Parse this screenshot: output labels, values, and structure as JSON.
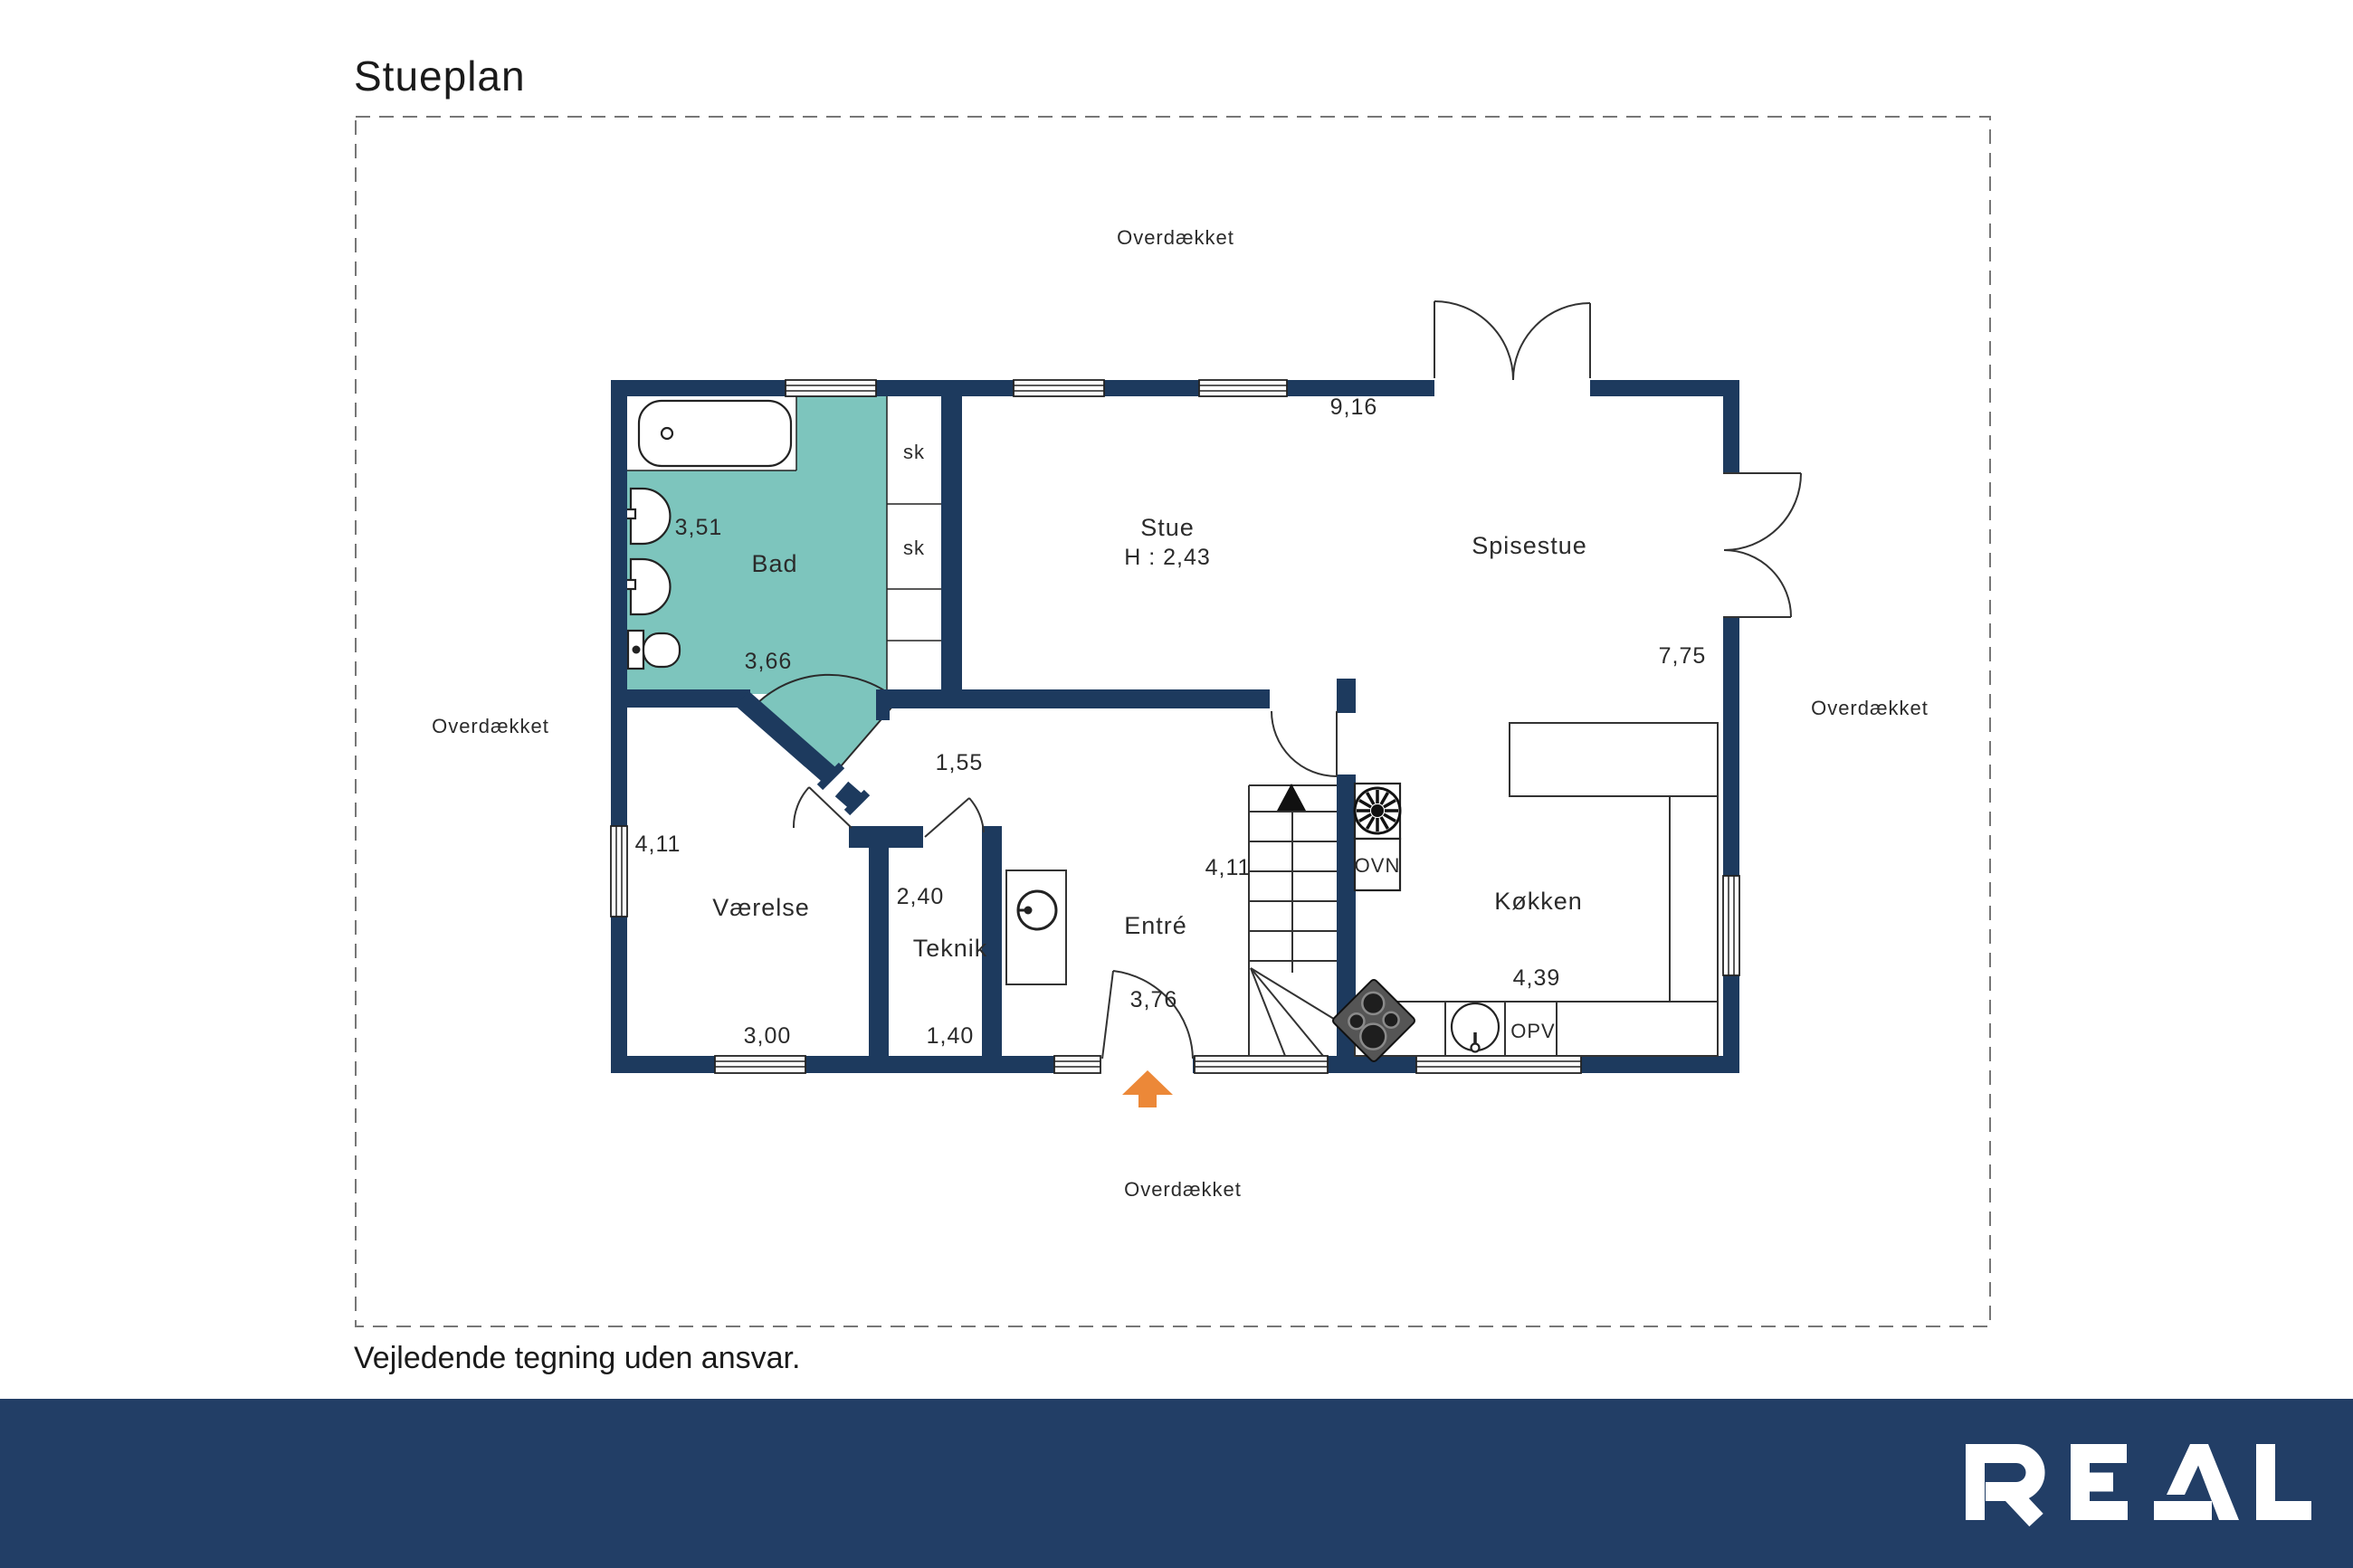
{
  "page": {
    "title": "Stueplan",
    "disclaimer": "Vejledende tegning uden ansvar."
  },
  "brand": {
    "logo_text": "REAL"
  },
  "colors": {
    "wall": "#1d3a5e",
    "bathroom_floor": "#7dc5bd",
    "entry_arrow": "#ec8838",
    "footer_bar": "#223e66"
  },
  "plan": {
    "covered": {
      "top": "Overdækket",
      "right": "Overdækket",
      "left": "Overdækket",
      "bottom": "Overdækket"
    },
    "rooms": {
      "bad": {
        "name": "Bad",
        "w": "3,51",
        "d": "3,66"
      },
      "stue": {
        "name": "Stue",
        "ceiling": "H : 2,43",
        "w": "9,16"
      },
      "spisestue": {
        "name": "Spisestue",
        "d": "7,75"
      },
      "vaerelse": {
        "name": "Værelse",
        "d": "4,11",
        "w": "3,00"
      },
      "teknik": {
        "name": "Teknik",
        "d": "2,40",
        "w": "1,40"
      },
      "entre": {
        "name": "Entré",
        "w": "3,76"
      },
      "koekken": {
        "name": "Køkken",
        "w": "4,39"
      }
    },
    "hall_width": "1,55",
    "stairs_depth": "4,11",
    "closets": {
      "c1": "sk",
      "c2": "sk"
    },
    "appliances": {
      "oven": "OVN",
      "dishwasher": "OPV"
    }
  }
}
